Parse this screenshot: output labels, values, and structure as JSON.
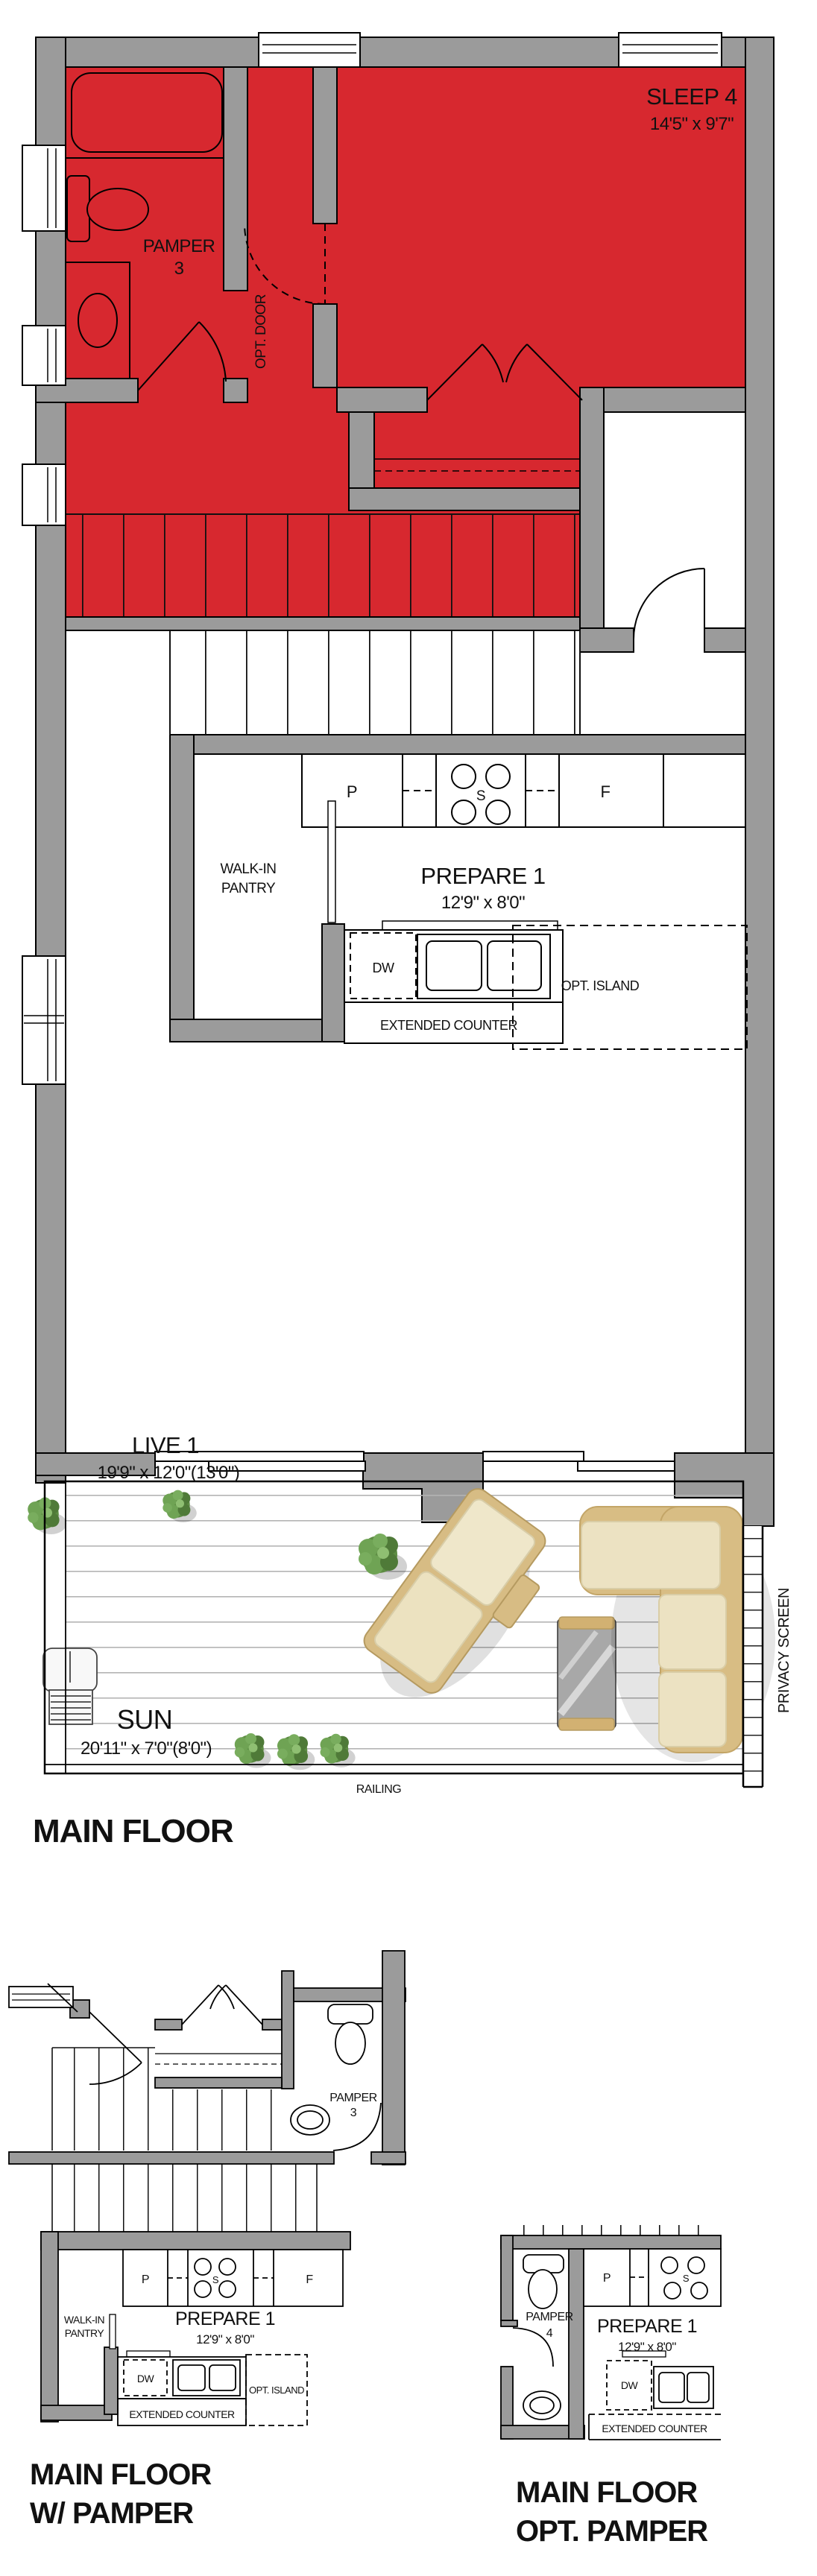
{
  "colors": {
    "highlight": "#d7282f",
    "wall": "#9b9b9b",
    "outline": "#000000",
    "cushion": "#ece2c2",
    "wicker": "#d8bd84"
  },
  "main_floor": {
    "title": "MAIN FLOOR",
    "sleep4_name": "SLEEP 4",
    "sleep4_dims": "14'5\" x 9'7\"",
    "pamper_name": "PAMPER",
    "pamper_num": "3",
    "opt_door": "OPT. DOOR",
    "walkin_1": "WALK-IN",
    "walkin_2": "PANTRY",
    "prepare_name": "PREPARE 1",
    "prepare_dims": "12'9\" x 8'0\"",
    "p": "P",
    "s": "S",
    "f": "F",
    "dw": "DW",
    "opt_island": "OPT. ISLAND",
    "extended_counter": "EXTENDED COUNTER",
    "live_name": "LIVE 1",
    "live_dims": "19'9\" x 12'0\"(13'0\")",
    "sun_name": "SUN",
    "sun_dims": "20'11\" x 7'0\"(8'0\")",
    "railing": "RAILING",
    "privacy_screen": "PRIVACY SCREEN"
  },
  "plan_w_pamper": {
    "title_1": "MAIN FLOOR",
    "title_2": "W/ PAMPER",
    "pamper_name": "PAMPER",
    "pamper_num": "3",
    "walkin_1": "WALK-IN",
    "walkin_2": "PANTRY",
    "prepare_name": "PREPARE 1",
    "prepare_dims": "12'9\" x 8'0\"",
    "p": "P",
    "s": "S",
    "f": "F",
    "dw": "DW",
    "opt_island": "OPT. ISLAND",
    "extended_counter": "EXTENDED COUNTER"
  },
  "plan_opt_pamper": {
    "title_1": "MAIN FLOOR",
    "title_2": "OPT. PAMPER",
    "pamper_name": "PAMPER",
    "pamper_num": "4",
    "prepare_name": "PREPARE 1",
    "prepare_dims": "12'9\" x 8'0\"",
    "p": "P",
    "s": "S",
    "dw": "DW",
    "extended_counter": "EXTENDED COUNTER"
  }
}
